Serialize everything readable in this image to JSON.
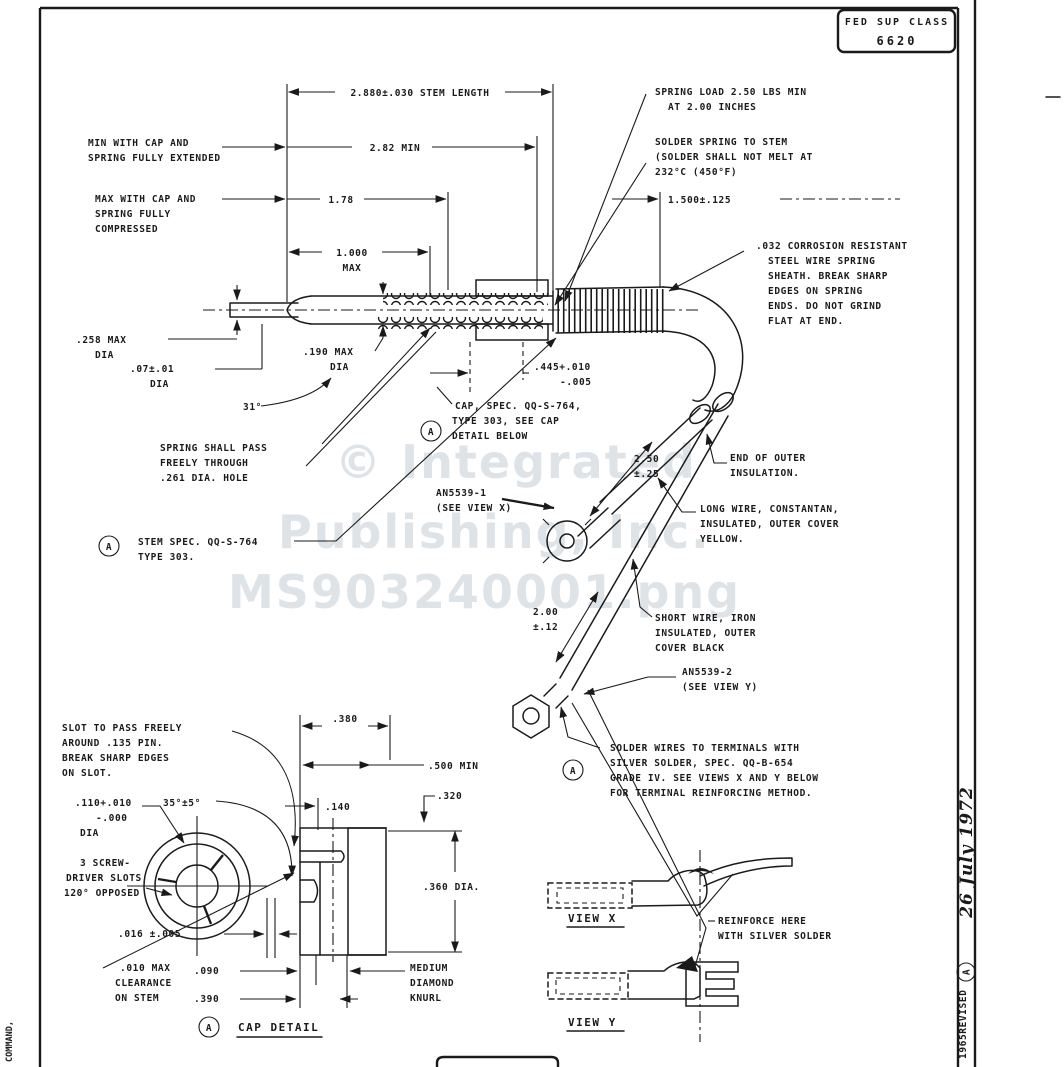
{
  "header": {
    "fed_sup_class_label": "FED SUP CLASS",
    "fed_sup_class_value": "6620",
    "flag_letter": "A"
  },
  "margins": {
    "left_vertical_text": "COMMAND,",
    "revision_text": "1965REVISED",
    "revision_date": "26 July 1972"
  },
  "watermark": {
    "line1": "© Integrated",
    "line2": "Publishing, Inc.",
    "line3": "MS903240001.png"
  },
  "dims": {
    "stem_length": "2.880±.030 STEM LENGTH",
    "min_extended": "2.82 MIN",
    "max_compressed": "1.78",
    "cap_travel": [
      "1.000",
      "MAX"
    ],
    "sheath_position": "1.500±.125",
    "tip_dia": [
      ".258 MAX",
      "DIA"
    ],
    "small_dia": [
      ".07±.01",
      "DIA"
    ],
    "body_dia": [
      ".190 MAX",
      "DIA"
    ],
    "bend_angle": "31°",
    "cap_length": [
      ".445+.010",
      "-.005"
    ],
    "wire_long": [
      "2.50",
      "±.25"
    ],
    "wire_short": [
      "2.00",
      "±.12"
    ]
  },
  "notes": {
    "min_cap": [
      "MIN WITH CAP AND",
      "SPRING FULLY EXTENDED"
    ],
    "max_cap": [
      "MAX WITH CAP AND",
      "SPRING FULLY",
      "COMPRESSED"
    ],
    "spring_load": [
      "SPRING LOAD 2.50 LBS MIN",
      "AT 2.00 INCHES"
    ],
    "solder_spring": [
      "SOLDER SPRING TO STEM",
      "(SOLDER SHALL NOT MELT AT",
      "232°C (450°F)"
    ],
    "sheath": [
      ".032 CORROSION RESISTANT",
      "STEEL WIRE SPRING",
      "SHEATH.  BREAK SHARP",
      "EDGES ON SPRING",
      "ENDS.  DO NOT GRIND",
      "FLAT AT END."
    ],
    "cap_spec": [
      "CAP, SPEC. QQ-S-764,",
      "TYPE 303, SEE CAP",
      "DETAIL BELOW"
    ],
    "spring_pass": [
      "SPRING SHALL PASS",
      "FREELY THROUGH",
      ".261 DIA. HOLE"
    ],
    "stem_spec": [
      "STEM SPEC. QQ-S-764",
      "TYPE 303."
    ],
    "end_insulation": [
      "END OF OUTER",
      "INSULATION."
    ],
    "an5539_1": [
      "AN5539-1",
      "(SEE VIEW X)"
    ],
    "long_wire": [
      "LONG WIRE, CONSTANTAN,",
      "INSULATED, OUTER COVER",
      "YELLOW."
    ],
    "short_wire": [
      "SHORT WIRE, IRON",
      "INSULATED, OUTER",
      "COVER BLACK"
    ],
    "an5539_2": [
      "AN5539-2",
      "(SEE VIEW Y)"
    ],
    "solder_wires": [
      "SOLDER WIRES TO TERMINALS WITH",
      "SILVER SOLDER, SPEC. QQ-B-654",
      "GRADE IV.  SEE VIEWS X AND Y BELOW",
      "FOR TERMINAL REINFORCING METHOD."
    ],
    "reinforce": [
      "REINFORCE HERE",
      "WITH SILVER SOLDER"
    ]
  },
  "cap_detail": {
    "slot_note": [
      "SLOT TO PASS FREELY",
      "AROUND .135 PIN.",
      "BREAK SHARP EDGES",
      "ON SLOT."
    ],
    "hole_dia": [
      ".110+.010",
      "-.000",
      "DIA"
    ],
    "slot_angle": "35°±5°",
    "screwdriver": [
      "3 SCREW-",
      "DRIVER SLOTS",
      "120° OPPOSED"
    ],
    "slot_width": ".016 ±.005",
    "clearance": [
      ".010 MAX",
      "CLEARANCE",
      "ON STEM"
    ],
    "dim_380": ".380",
    "dim_500": ".500 MIN",
    "dim_320": ".320",
    "dim_140": ".140",
    "dim_360": ".360 DIA.",
    "dim_090": ".090",
    "dim_390": ".390",
    "knurl": [
      "MEDIUM",
      "DIAMOND",
      "KNURL"
    ],
    "title": "CAP DETAIL"
  },
  "views": {
    "view_x": "VIEW X",
    "view_y": "VIEW Y"
  }
}
